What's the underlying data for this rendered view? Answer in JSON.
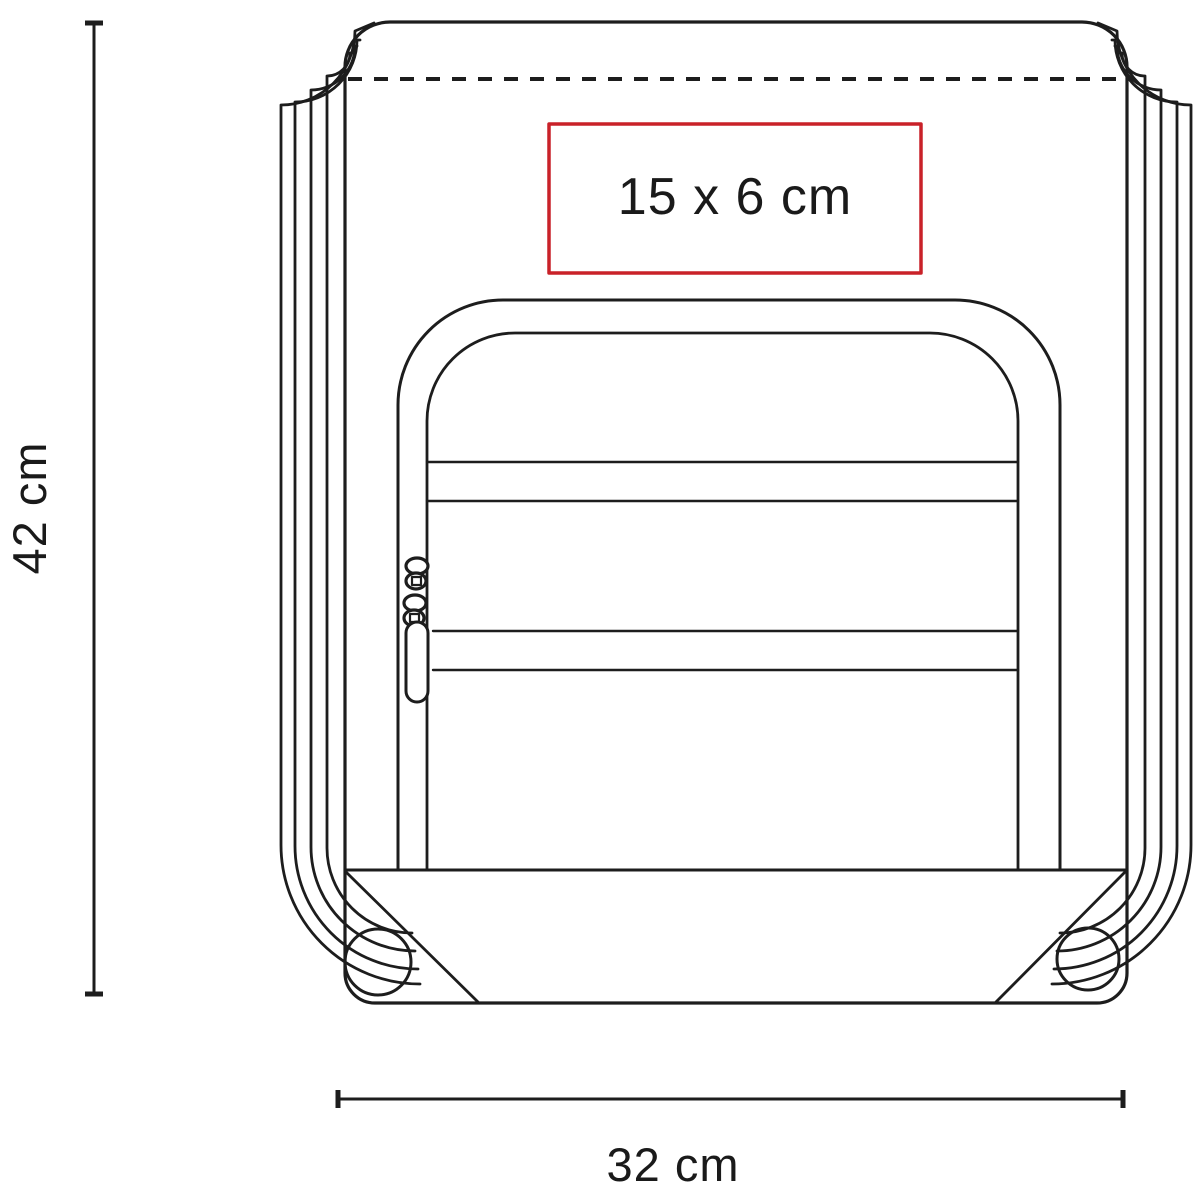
{
  "diagram": {
    "labels": {
      "height": "42 cm",
      "width": "32 cm",
      "print_area": "15 x 6 cm"
    },
    "colors": {
      "line": "#1d1d1d",
      "text": "#1a1a1a",
      "print_area_border": "#c92128",
      "zipper_shadow": "#8a8a8a",
      "background": "#ffffff"
    }
  }
}
